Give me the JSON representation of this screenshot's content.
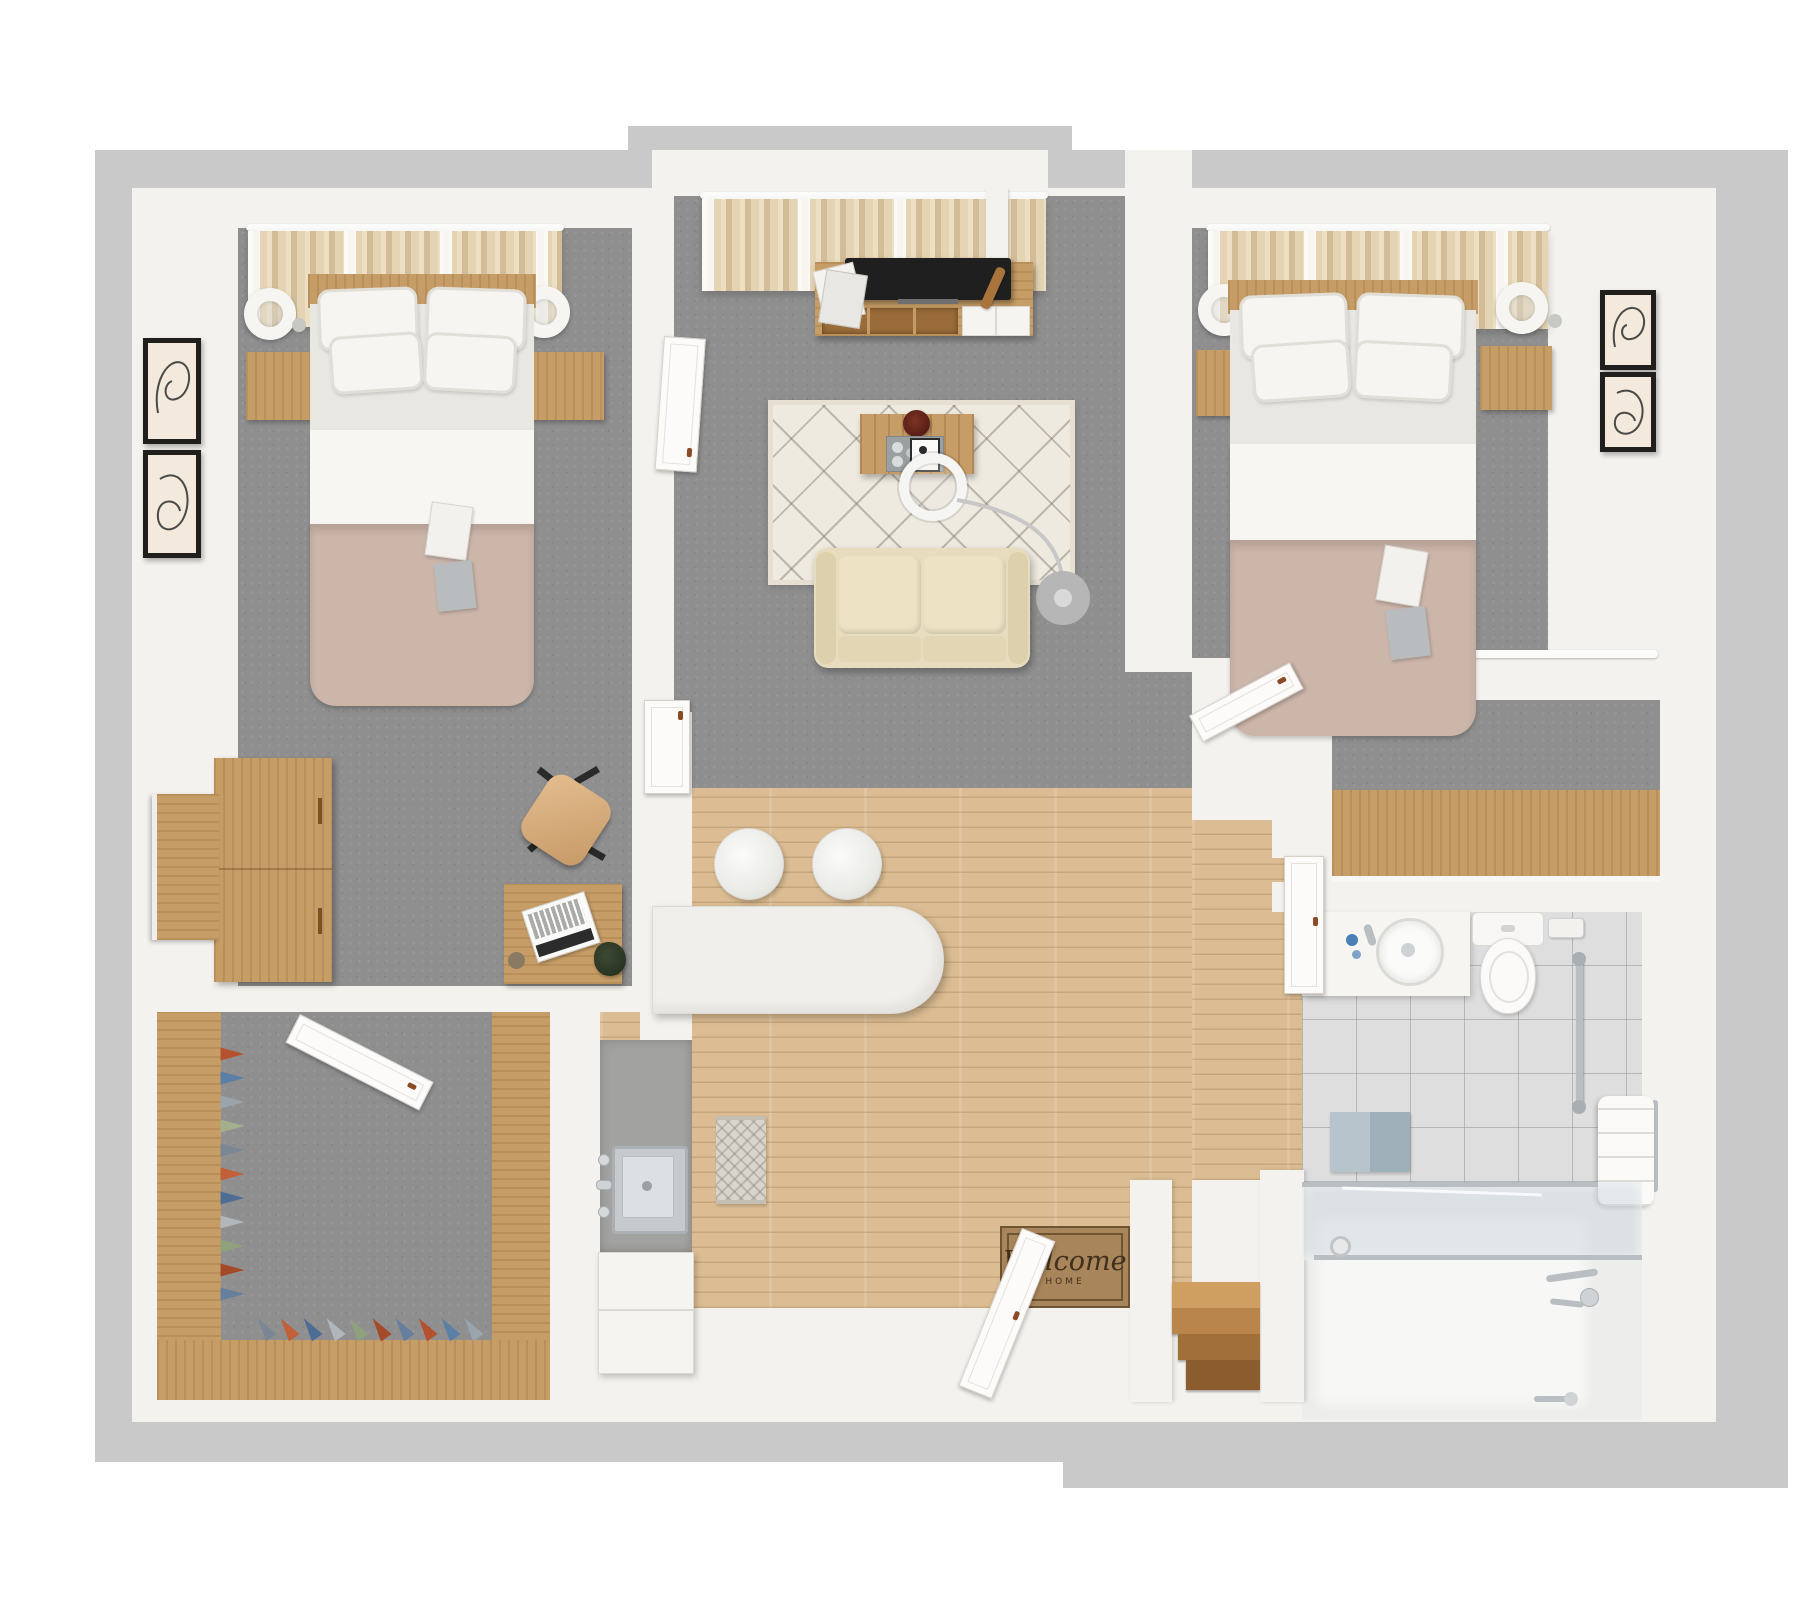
{
  "doormat": {
    "line1": "Welcome",
    "line2": "HOME"
  },
  "palette": {
    "outer_wall": "#c9c9c9",
    "inner_wall": "#f4f2ee",
    "carpet": "#8f8f8f",
    "wood_floor": "#dcbd93",
    "furniture_wood": "#c69d66",
    "curtain": "#dcc8a5",
    "duvet": "#ccb5a9",
    "sofa": "#e7dcbd",
    "rug": "#efeae0",
    "bathroom_tile": "#dedede",
    "doormat_brown": "#a9855b",
    "tv_black": "#1f1f1f"
  },
  "closet_shoes": {
    "colors": [
      "#b5512f",
      "#5b7fa6",
      "#9aa4ac",
      "#a3b08e",
      "#7b8794",
      "#c2603a",
      "#4f6d94",
      "#b0b6ba",
      "#8fa07c",
      "#a54a28",
      "#667f9e"
    ]
  },
  "inventory": {
    "bedroom_left": [
      "double-bed",
      "pillows",
      "duvet",
      "nightstands",
      "table-lamps",
      "curtains",
      "wall-art-frames",
      "wardrobe",
      "desk",
      "laptop",
      "desk-chair",
      "plant"
    ],
    "living_room": [
      "curtains",
      "tv-console",
      "tv",
      "magazines",
      "area-rug",
      "coffee-table",
      "arc-floor-lamp",
      "loveseat-sofa"
    ],
    "bedroom_right": [
      "double-bed",
      "pillows",
      "duvet",
      "nightstands",
      "table-lamps",
      "curtains",
      "wall-art-frames",
      "reach-in-closet"
    ],
    "kitchen": [
      "breakfast-bar",
      "bar-stools",
      "sink",
      "countertop",
      "cabinets",
      "runner-rug"
    ],
    "bathroom": [
      "vanity-sink",
      "toilet",
      "toilet-paper-holder",
      "grab-bar",
      "bath-mat",
      "towels",
      "walk-in-shower",
      "glass-sliding-door"
    ],
    "entry": [
      "welcome-doormat",
      "entry-door",
      "steps"
    ],
    "walk_in_closet": [
      "shelving",
      "shoe-rows"
    ]
  }
}
